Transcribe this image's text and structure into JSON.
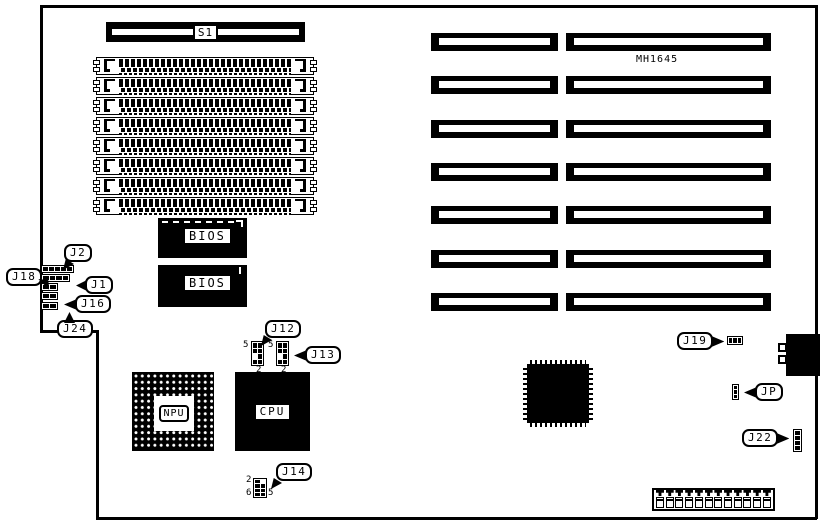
{
  "board": {
    "id_label": "MH1645",
    "switch_label": "S1",
    "bios1_label": "BIOS",
    "bios2_label": "BIOS",
    "npu_label": "NPU",
    "cpu_label": "CPU"
  },
  "callouts": {
    "j1": "J1",
    "j2": "J2",
    "j12": "J12",
    "j13": "J13",
    "j14": "J14",
    "j16": "J16",
    "j18": "J18",
    "j19": "J19",
    "j22": "J22",
    "j24": "J24",
    "jp": "JP"
  },
  "pin_labels": {
    "j12_pin5": "5",
    "j12_pin2": "2",
    "j13_pin5": "5",
    "j13_pin2": "2",
    "j14_pin2": "2",
    "j14_pin6": "6",
    "j14_pin5": "5"
  },
  "counts": {
    "simm_sockets": 8,
    "expansion_slot_rows": 7,
    "power_pins": 12
  },
  "colors": {
    "ink": "#000000",
    "paper": "#ffffff"
  }
}
